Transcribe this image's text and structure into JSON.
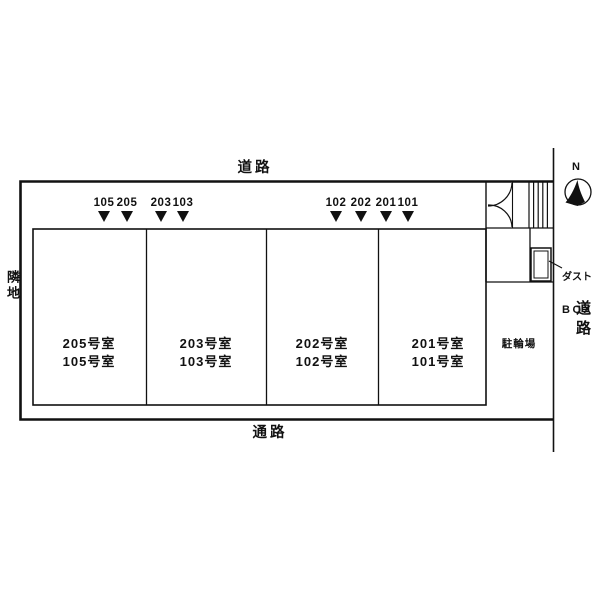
{
  "labels": {
    "road_top": "道路",
    "road_right": "道路",
    "passage_bottom": "通路",
    "neighbor_left": "隣地",
    "bike_parking": "駐輪場",
    "dust_box_line1": "ダスト",
    "dust_box_line2": "BOX",
    "north": "N"
  },
  "stalls": [
    {
      "label": "105"
    },
    {
      "label": "205"
    },
    {
      "label": "203"
    },
    {
      "label": "103"
    },
    {
      "label": "102"
    },
    {
      "label": "202"
    },
    {
      "label": "201"
    },
    {
      "label": "101"
    }
  ],
  "rooms": [
    {
      "upper": "205号室",
      "lower": "105号室"
    },
    {
      "upper": "203号室",
      "lower": "103号室"
    },
    {
      "upper": "202号室",
      "lower": "102号室"
    },
    {
      "upper": "201号室",
      "lower": "101号室"
    }
  ],
  "colors": {
    "line": "#111111",
    "background": "#ffffff"
  }
}
